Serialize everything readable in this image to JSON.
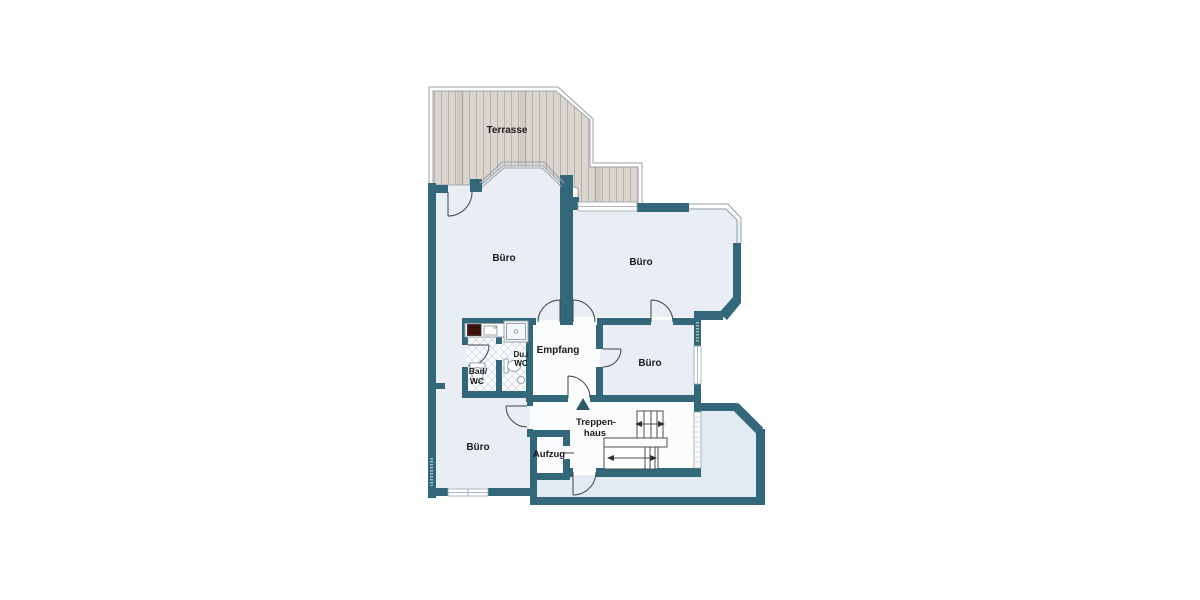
{
  "floorplan": {
    "labels": {
      "terrasse": "Terrasse",
      "buero_top_left": "Büro",
      "buero_top_right": "Büro",
      "buero_middle_right": "Büro",
      "buero_bottom_left": "Büro",
      "empfang": "Empfang",
      "bad_wc_line1": "Bad/",
      "bad_wc_line2": "WC",
      "du_wc_line1": "Du./",
      "du_wc_line2": "WC",
      "treppenhaus_line1": "Treppen-",
      "treppenhaus_line2": "haus",
      "aufzug": "Aufzug"
    },
    "colors": {
      "wall": "#32687a",
      "room_office": "#e9eef4",
      "room_service": "#fbfcfd",
      "room_hall": "#e2ebf3",
      "terrace_wood": "#dbd5cf",
      "terrace_plank_line": "#b9b2ac",
      "outline": "#99a2a9",
      "stove": "#4e120c"
    }
  }
}
